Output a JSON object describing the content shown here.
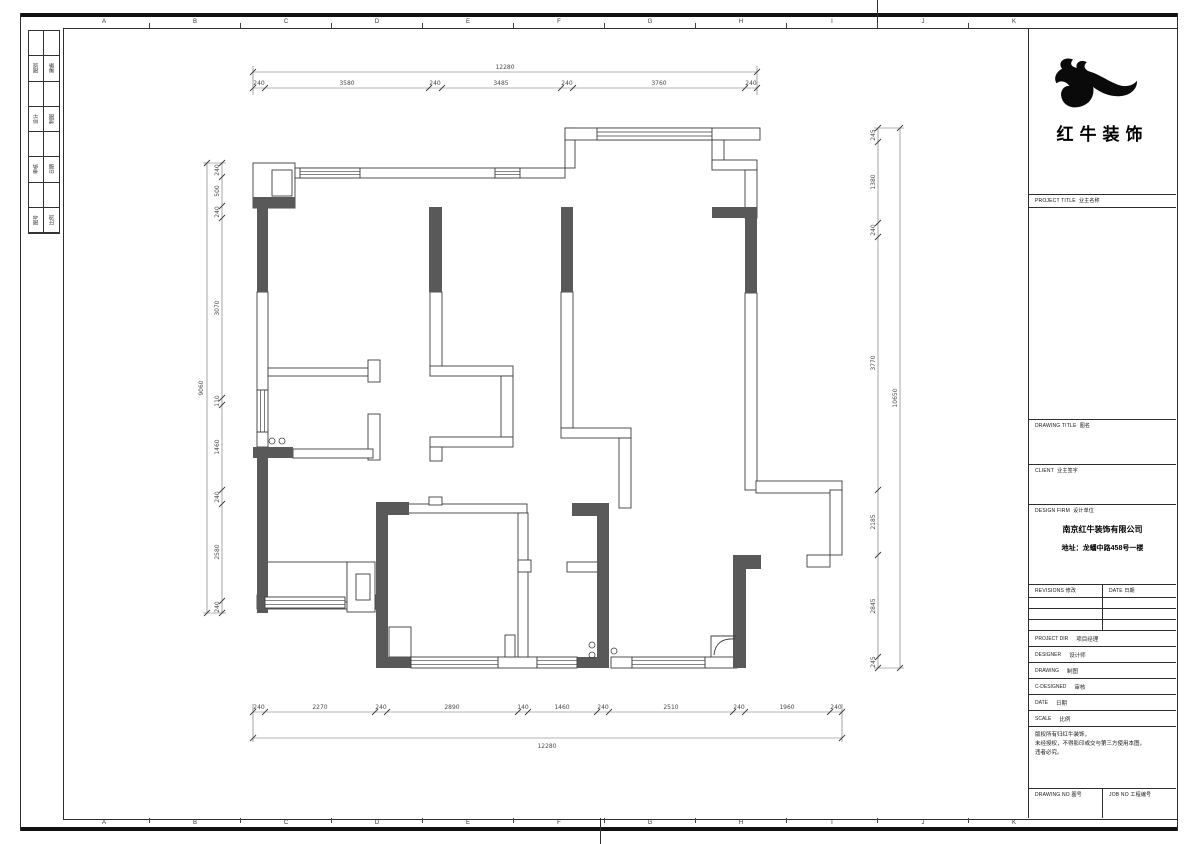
{
  "sheet": {
    "grid": {
      "letters": [
        "A",
        "B",
        "C",
        "D",
        "E",
        "F",
        "G",
        "H",
        "I",
        "J",
        "K"
      ],
      "letter_xs": [
        104,
        195,
        286,
        377,
        468,
        559,
        650,
        741,
        832,
        923,
        1014
      ],
      "tick_xs": [
        149,
        240,
        331,
        422,
        513,
        604,
        695,
        786,
        877,
        968
      ]
    },
    "index_rows": [
      {
        "cell": 2,
        "text": "图别"
      },
      {
        "cell": 3,
        "text": "建施"
      },
      {
        "cell": 6,
        "text": "设计"
      },
      {
        "cell": 7,
        "text": "制图"
      },
      {
        "cell": 10,
        "text": "审核"
      },
      {
        "cell": 11,
        "text": "日期"
      },
      {
        "cell": 14,
        "text": "图号"
      },
      {
        "cell": 15,
        "text": "比例"
      }
    ]
  },
  "title_block": {
    "logo_text": "红牛装饰",
    "project_title": {
      "en": "PROJECT TITLE",
      "cn": "业主名称"
    },
    "drawing_title": {
      "en": "DRAWING TITLE",
      "cn": "图名"
    },
    "client": {
      "en": "CLIENT",
      "cn": "业主签字"
    },
    "design_firm": {
      "en": "DESIGN FIRM",
      "cn": "设计单位"
    },
    "company": "南京红牛装饰有限公司",
    "address": "地址：龙蟠中路458号一楼",
    "revisions": {
      "en": "REVISIONS",
      "cn": "修改"
    },
    "rev_date": {
      "en": "DATE",
      "cn": "日期"
    },
    "rows": [
      {
        "en": "PROJECT DIR",
        "cn": "项目经理"
      },
      {
        "en": "DESIGNER",
        "cn": "设计师"
      },
      {
        "en": "DRAWING",
        "cn": "制图"
      },
      {
        "en": "C-DESIGNED",
        "cn": "审核"
      },
      {
        "en": "DATE",
        "cn": "日期"
      },
      {
        "en": "SCALE",
        "cn": "比例"
      }
    ],
    "notes": [
      "版权所有归红牛装饰，",
      "未经授权，不得影印或交与第三方使用本图，",
      "违者必究。"
    ],
    "drawing_no": {
      "en": "DRAWING NO",
      "cn": "图号"
    },
    "job_no": {
      "en": "JOB NO",
      "cn": "工程编号"
    }
  },
  "plan": {
    "colors": {
      "wall_dark": "#595959",
      "line": "#3d3d3d",
      "dim": "#6a6a6a",
      "dim_text": "#4a4a4a"
    },
    "white_walls": [
      [
        253,
        163,
        42,
        45
      ],
      [
        272,
        170,
        20,
        26
      ],
      [
        295,
        168,
        270,
        10
      ],
      [
        565,
        128,
        10,
        40
      ],
      [
        565,
        128,
        195,
        12
      ],
      [
        712,
        140,
        12,
        28
      ],
      [
        712,
        160,
        45,
        10
      ],
      [
        745,
        170,
        12,
        48
      ],
      [
        745,
        293,
        12,
        197
      ],
      [
        756,
        481,
        86,
        12
      ],
      [
        830,
        490,
        12,
        65
      ],
      [
        807,
        555,
        23,
        12
      ],
      [
        257,
        292,
        11,
        98
      ],
      [
        257,
        432,
        11,
        15
      ],
      [
        257,
        595,
        119,
        14
      ],
      [
        498,
        657,
        39,
        11
      ],
      [
        611,
        657,
        21,
        11
      ],
      [
        705,
        657,
        32,
        11
      ],
      [
        268,
        368,
        108,
        8
      ],
      [
        368,
        360,
        12,
        22
      ],
      [
        368,
        414,
        12,
        46
      ],
      [
        293,
        449,
        80,
        9
      ],
      [
        430,
        292,
        12,
        76
      ],
      [
        430,
        366,
        83,
        10
      ],
      [
        501,
        376,
        12,
        61
      ],
      [
        430,
        437,
        83,
        10
      ],
      [
        430,
        447,
        12,
        14
      ],
      [
        561,
        292,
        12,
        136
      ],
      [
        561,
        428,
        70,
        10
      ],
      [
        619,
        438,
        12,
        70
      ],
      [
        408,
        504,
        119,
        9
      ],
      [
        429,
        497,
        13,
        8
      ],
      [
        518,
        513,
        10,
        144
      ],
      [
        518,
        560,
        13,
        12
      ],
      [
        567,
        562,
        31,
        10
      ],
      [
        265,
        562,
        82,
        40
      ],
      [
        347,
        562,
        28,
        50
      ],
      [
        356,
        574,
        14,
        26
      ],
      [
        389,
        627,
        22,
        30
      ],
      [
        505,
        635,
        10,
        22
      ]
    ],
    "dark_walls": [
      [
        253,
        197,
        42,
        11
      ],
      [
        257,
        207,
        11,
        85
      ],
      [
        429,
        207,
        13,
        85
      ],
      [
        561,
        207,
        12,
        85
      ],
      [
        712,
        207,
        45,
        11
      ],
      [
        745,
        218,
        12,
        75
      ],
      [
        253,
        447,
        40,
        11
      ],
      [
        257,
        447,
        11,
        166
      ],
      [
        376,
        502,
        12,
        166
      ],
      [
        376,
        502,
        33,
        13
      ],
      [
        388,
        657,
        23,
        11
      ],
      [
        572,
        503,
        37,
        13
      ],
      [
        597,
        516,
        12,
        152
      ],
      [
        577,
        657,
        20,
        11
      ],
      [
        733,
        555,
        28,
        14
      ],
      [
        733,
        569,
        13,
        99
      ]
    ],
    "windows": [
      [
        300,
        168,
        60,
        10
      ],
      [
        495,
        168,
        25,
        10
      ],
      [
        597,
        128,
        115,
        12
      ],
      [
        265,
        597,
        80,
        11
      ],
      [
        411,
        657,
        87,
        11
      ],
      [
        537,
        657,
        40,
        11
      ],
      [
        632,
        657,
        73,
        11
      ],
      [
        257,
        390,
        11,
        42
      ]
    ],
    "circles": [
      [
        272,
        441
      ],
      [
        282,
        441
      ],
      [
        592,
        645
      ],
      [
        592,
        655
      ],
      [
        614,
        651
      ]
    ],
    "shower": {
      "frame": "M711,657 L711,636 L736,636",
      "arc": "M714,655 C715,643 723,638 735,639"
    },
    "dim_lines": [
      [
        253,
        72,
        757,
        72
      ],
      [
        253,
        88,
        757,
        88
      ],
      [
        253,
        712,
        842,
        712
      ],
      [
        253,
        738,
        842,
        738
      ],
      [
        222,
        163,
        222,
        613
      ],
      [
        207,
        163,
        207,
        613
      ],
      [
        878,
        128,
        878,
        668
      ],
      [
        900,
        128,
        900,
        668
      ],
      [
        253,
        66,
        253,
        95
      ],
      [
        757,
        66,
        757,
        95
      ],
      [
        253,
        704,
        253,
        742
      ],
      [
        842,
        704,
        842,
        742
      ],
      [
        203,
        163,
        226,
        163
      ],
      [
        203,
        613,
        226,
        613
      ],
      [
        874,
        128,
        904,
        128
      ],
      [
        874,
        668,
        904,
        668
      ]
    ],
    "dim_ticks": [
      [
        253,
        72
      ],
      [
        757,
        72
      ],
      [
        253,
        88
      ],
      [
        265,
        88
      ],
      [
        429,
        88
      ],
      [
        442,
        88
      ],
      [
        561,
        88
      ],
      [
        573,
        88
      ],
      [
        745,
        88
      ],
      [
        757,
        88
      ],
      [
        253,
        712
      ],
      [
        265,
        712
      ],
      [
        375,
        712
      ],
      [
        387,
        712
      ],
      [
        518,
        712
      ],
      [
        528,
        712
      ],
      [
        597,
        712
      ],
      [
        609,
        712
      ],
      [
        733,
        712
      ],
      [
        745,
        712
      ],
      [
        830,
        712
      ],
      [
        842,
        712
      ],
      [
        253,
        738
      ],
      [
        842,
        738
      ],
      [
        222,
        163
      ],
      [
        222,
        177
      ],
      [
        222,
        206
      ],
      [
        222,
        218
      ],
      [
        222,
        398
      ],
      [
        222,
        405
      ],
      [
        222,
        490
      ],
      [
        222,
        504
      ],
      [
        222,
        601
      ],
      [
        222,
        613
      ],
      [
        207,
        163
      ],
      [
        207,
        613
      ],
      [
        878,
        128
      ],
      [
        878,
        142
      ],
      [
        878,
        223
      ],
      [
        878,
        237
      ],
      [
        878,
        490
      ],
      [
        878,
        555
      ],
      [
        878,
        657
      ],
      [
        878,
        668
      ],
      [
        900,
        128
      ],
      [
        900,
        668
      ]
    ],
    "dim_labels": [
      [
        "12280",
        505,
        69,
        0
      ],
      [
        "240",
        259,
        85,
        0
      ],
      [
        "3580",
        347,
        85,
        0
      ],
      [
        "240",
        435,
        85,
        0
      ],
      [
        "3485",
        501,
        85,
        0
      ],
      [
        "240",
        567,
        85,
        0
      ],
      [
        "3760",
        659,
        85,
        0
      ],
      [
        "240",
        751,
        85,
        0
      ],
      [
        "240",
        259,
        709,
        0
      ],
      [
        "2270",
        320,
        709,
        0
      ],
      [
        "240",
        381,
        709,
        0
      ],
      [
        "2890",
        452,
        709,
        0
      ],
      [
        "140",
        523,
        709,
        0
      ],
      [
        "1460",
        562,
        709,
        0
      ],
      [
        "240",
        603,
        709,
        0
      ],
      [
        "2510",
        671,
        709,
        0
      ],
      [
        "240",
        739,
        709,
        0
      ],
      [
        "1960",
        787,
        709,
        0
      ],
      [
        "240",
        836,
        709,
        0
      ],
      [
        "12280",
        547,
        748,
        0
      ],
      [
        "9060",
        203,
        388,
        -90
      ],
      [
        "240",
        219,
        170,
        -90
      ],
      [
        "500",
        219,
        191,
        -90
      ],
      [
        "240",
        219,
        212,
        -90
      ],
      [
        "3070",
        219,
        308,
        -90
      ],
      [
        "110",
        219,
        401,
        -90
      ],
      [
        "1460",
        219,
        447,
        -90
      ],
      [
        "240",
        219,
        497,
        -90
      ],
      [
        "2580",
        219,
        552,
        -90
      ],
      [
        "240",
        219,
        607,
        -90
      ],
      [
        "10650",
        897,
        398,
        -90
      ],
      [
        "245",
        875,
        135,
        -90
      ],
      [
        "1380",
        875,
        182,
        -90
      ],
      [
        "240",
        875,
        230,
        -90
      ],
      [
        "3770",
        875,
        363,
        -90
      ],
      [
        "2185",
        875,
        522,
        -90
      ],
      [
        "2845",
        875,
        606,
        -90
      ],
      [
        "245",
        875,
        662,
        -90
      ]
    ]
  }
}
